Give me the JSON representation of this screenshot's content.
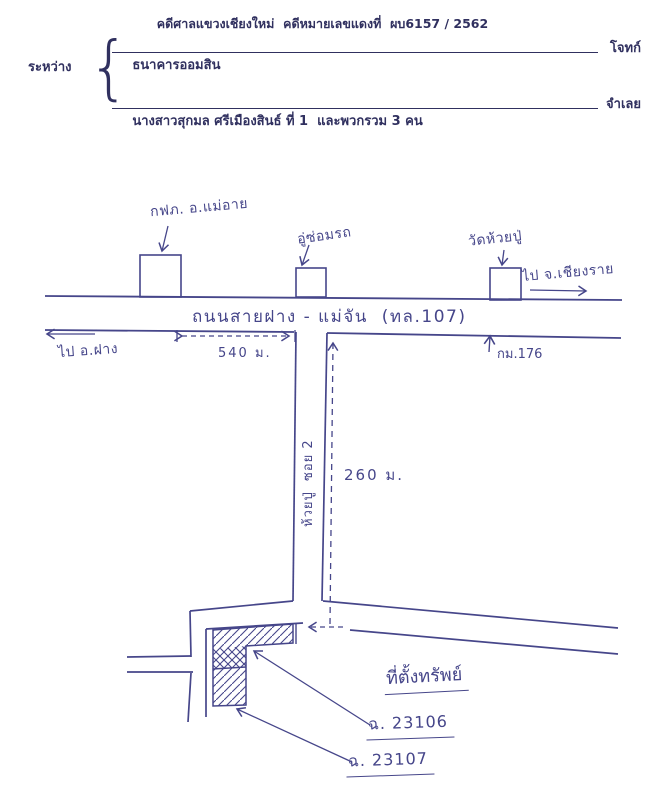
{
  "header": {
    "title": "คดีศาลแขวงเชียงใหม่  คดีหมายเลขแดงที่  ผบ6157 / 2562",
    "between_label": "ระหว่าง",
    "brace": "{",
    "plaintiff": {
      "name": "ธนาคารออมสิน",
      "role": "โจทก์"
    },
    "defendant": {
      "name": "นางสาวสุกมล ศรีเมืองสินธ์ ที่ 1  และพวกรวม 3 คน",
      "role": "จำเลย"
    }
  },
  "map": {
    "landmarks": {
      "pea_office": "กฟภ. อ.แม่อาย",
      "garage": "อู่ซ่อมรถ",
      "temple": "วัดห้วยปู่"
    },
    "directions": {
      "to_chiangrai": "ไป จ.เชียงราย",
      "to_fang": "ไป อ.ฝาง"
    },
    "main_road_name": "ถนนสายฝาง - แม่จัน  (ทล.107)",
    "soi_name": "ห้วยปู่  ซอย 2",
    "distance_along_road": "540 ม.",
    "distance_along_soi": "260 ม.",
    "km_marker": "กม.176",
    "property": {
      "location_label": "ที่ตั้งทรัพย์",
      "deed_1": "ฉ. 23106",
      "deed_2": "ฉ. 23107"
    },
    "colors": {
      "ink": "#46468a",
      "print": "#30305f"
    }
  }
}
